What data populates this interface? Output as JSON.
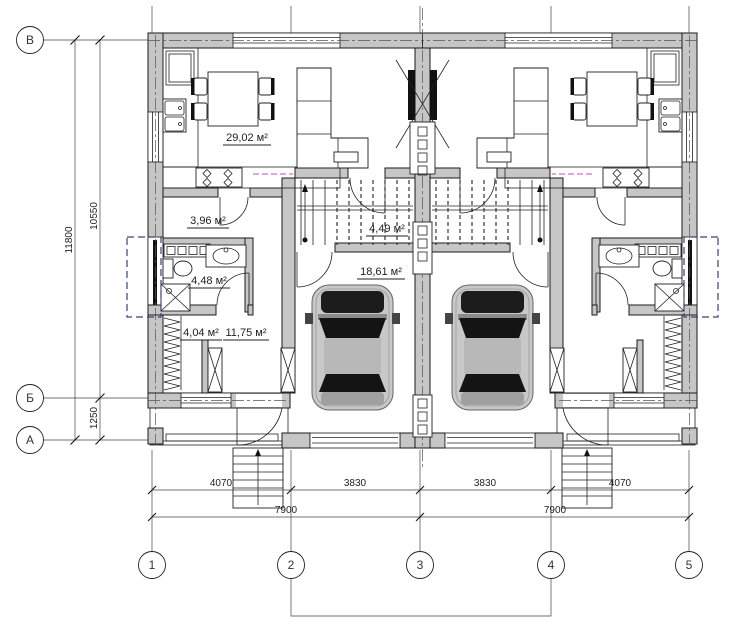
{
  "plan": {
    "axis_letters": [
      "В",
      "Б",
      "А"
    ],
    "axis_numbers": [
      "1",
      "2",
      "3",
      "4",
      "5"
    ],
    "dims": {
      "overall_v": "11800",
      "upper_v": "10550",
      "lower_v": "1250",
      "seg1": "4070",
      "seg2": "3830",
      "seg3": "3830",
      "seg4": "4070",
      "total_left": "7900",
      "total_right": "7900"
    },
    "areas": {
      "living": "29,02 м²",
      "hall": "3,96 м²",
      "bath": "4,48 м²",
      "entry": "4,04 м²",
      "room": "11,75 м²",
      "stair": "4,49 м²",
      "garage": "18,61 м²"
    }
  },
  "colors": {
    "wall_fill": "#c6c6c6",
    "line": "#1a1a1a",
    "terrace_dash": "#3a4472",
    "magenta_dash": "#c553b0",
    "car_body": "#c8c8c8",
    "car_glass": "#141414"
  }
}
